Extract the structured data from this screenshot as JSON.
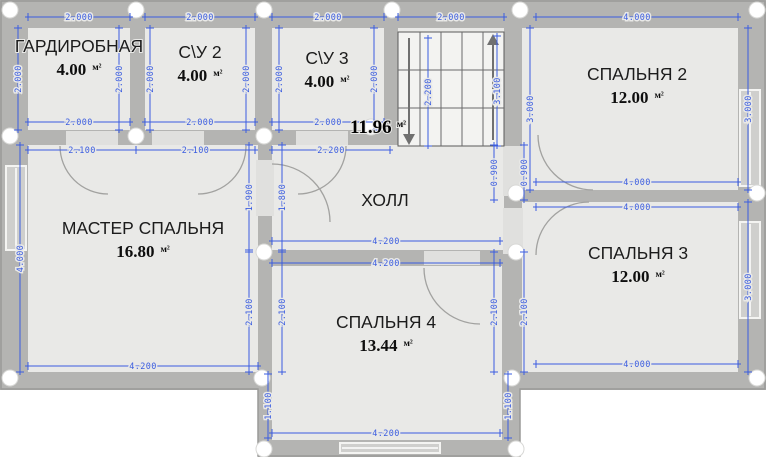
{
  "plan": {
    "unit": "м²",
    "colors": {
      "wall": "#b4b4b2",
      "floor": "#e9e9e7",
      "dimension_blue": "#3a5ce0",
      "label_black": "#1c1c1c",
      "background": "#ffffff"
    },
    "rooms": [
      {
        "id": "wardrobe",
        "name": "ГАРДИРОБНАЯ",
        "area": "4.00",
        "cx": 79,
        "cy": 52
      },
      {
        "id": "bathroom-2",
        "name": "С\\У 2",
        "area": "4.00",
        "cx": 200,
        "cy": 58
      },
      {
        "id": "bathroom-3",
        "name": "С\\У 3",
        "area": "4.00",
        "cx": 327,
        "cy": 64
      },
      {
        "id": "bedroom-2",
        "name": "СПАЛЬНЯ 2",
        "area": "12.00",
        "cx": 637,
        "cy": 80
      },
      {
        "id": "master-bedroom",
        "name": "МАСТЕР СПАЛЬНЯ",
        "area": "16.80",
        "cx": 143,
        "cy": 234
      },
      {
        "id": "hall",
        "name": "ХОЛЛ",
        "area": null,
        "cx": 385,
        "cy": 206
      },
      {
        "id": "bedroom-3",
        "name": "СПАЛЬНЯ 3",
        "area": "12.00",
        "cx": 638,
        "cy": 259
      },
      {
        "id": "bedroom-4",
        "name": "СПАЛЬНЯ 4",
        "area": "13.44",
        "cx": 386,
        "cy": 328
      }
    ],
    "hall_area_label": {
      "value": "11.96",
      "cx": 378,
      "cy": 133
    },
    "dimensions": {
      "horizontal": [
        {
          "v": "2.000",
          "x1": 28,
          "x2": 130,
          "y": 17
        },
        {
          "v": "2.000",
          "x1": 145,
          "x2": 255,
          "y": 17
        },
        {
          "v": "2.000",
          "x1": 272,
          "x2": 384,
          "y": 17
        },
        {
          "v": "2.000",
          "x1": 398,
          "x2": 504,
          "y": 17
        },
        {
          "v": "4.000",
          "x1": 536,
          "x2": 738,
          "y": 17
        },
        {
          "v": "2.000",
          "x1": 28,
          "x2": 130,
          "y": 122
        },
        {
          "v": "2.000",
          "x1": 145,
          "x2": 255,
          "y": 122
        },
        {
          "v": "2.000",
          "x1": 272,
          "x2": 384,
          "y": 122
        },
        {
          "v": "2.100",
          "x1": 28,
          "x2": 136,
          "y": 150
        },
        {
          "v": "2.100",
          "x1": 136,
          "x2": 255,
          "y": 150
        },
        {
          "v": "2.200",
          "x1": 272,
          "x2": 390,
          "y": 150
        },
        {
          "v": "4.000",
          "x1": 536,
          "x2": 738,
          "y": 182
        },
        {
          "v": "4.000",
          "x1": 536,
          "x2": 738,
          "y": 207
        },
        {
          "v": "4.200",
          "x1": 272,
          "x2": 500,
          "y": 241
        },
        {
          "v": "4.200",
          "x1": 272,
          "x2": 500,
          "y": 263
        },
        {
          "v": "4.200",
          "x1": 28,
          "x2": 258,
          "y": 366
        },
        {
          "v": "4.000",
          "x1": 536,
          "x2": 738,
          "y": 364
        },
        {
          "v": "4.200",
          "x1": 272,
          "x2": 500,
          "y": 433
        }
      ],
      "vertical": [
        {
          "v": "2.000",
          "x": 18,
          "y1": 28,
          "y2": 130
        },
        {
          "v": "4.000",
          "x": 20,
          "y1": 145,
          "y2": 372
        },
        {
          "v": "2.000",
          "x": 119,
          "y1": 28,
          "y2": 130
        },
        {
          "v": "2.000",
          "x": 150,
          "y1": 28,
          "y2": 130
        },
        {
          "v": "2.000",
          "x": 246,
          "y1": 28,
          "y2": 130
        },
        {
          "v": "2.000",
          "x": 279,
          "y1": 28,
          "y2": 130
        },
        {
          "v": "2.000",
          "x": 374,
          "y1": 28,
          "y2": 130
        },
        {
          "v": "2.200",
          "x": 428,
          "y1": 38,
          "y2": 146
        },
        {
          "v": "3.100",
          "x": 497,
          "y1": 36,
          "y2": 146
        },
        {
          "v": "3.000",
          "x": 530,
          "y1": 28,
          "y2": 190
        },
        {
          "v": "3.000",
          "x": 748,
          "y1": 28,
          "y2": 190
        },
        {
          "v": "3.000",
          "x": 748,
          "y1": 202,
          "y2": 372
        },
        {
          "v": "1.900",
          "x": 249,
          "y1": 145,
          "y2": 250
        },
        {
          "v": "1.800",
          "x": 282,
          "y1": 145,
          "y2": 250
        },
        {
          "v": "2.100",
          "x": 249,
          "y1": 252,
          "y2": 372
        },
        {
          "v": "2.100",
          "x": 282,
          "y1": 252,
          "y2": 372
        },
        {
          "v": "0.900",
          "x": 494,
          "y1": 145,
          "y2": 200
        },
        {
          "v": "0.900",
          "x": 524,
          "y1": 145,
          "y2": 200
        },
        {
          "v": "2.100",
          "x": 494,
          "y1": 252,
          "y2": 372
        },
        {
          "v": "2.100",
          "x": 524,
          "y1": 252,
          "y2": 372
        },
        {
          "v": "1.100",
          "x": 268,
          "y1": 374,
          "y2": 438
        },
        {
          "v": "1.100",
          "x": 508,
          "y1": 374,
          "y2": 438
        }
      ]
    },
    "columns": [
      [
        10,
        10
      ],
      [
        136,
        10
      ],
      [
        264,
        10
      ],
      [
        392,
        10
      ],
      [
        520,
        10
      ],
      [
        757,
        10
      ],
      [
        10,
        136
      ],
      [
        136,
        136
      ],
      [
        264,
        136
      ],
      [
        371,
        127
      ],
      [
        516,
        193
      ],
      [
        757,
        193
      ],
      [
        264,
        252
      ],
      [
        516,
        252
      ],
      [
        10,
        378
      ],
      [
        262,
        378
      ],
      [
        512,
        378
      ],
      [
        757,
        378
      ],
      [
        264,
        449
      ],
      [
        516,
        449
      ]
    ]
  }
}
